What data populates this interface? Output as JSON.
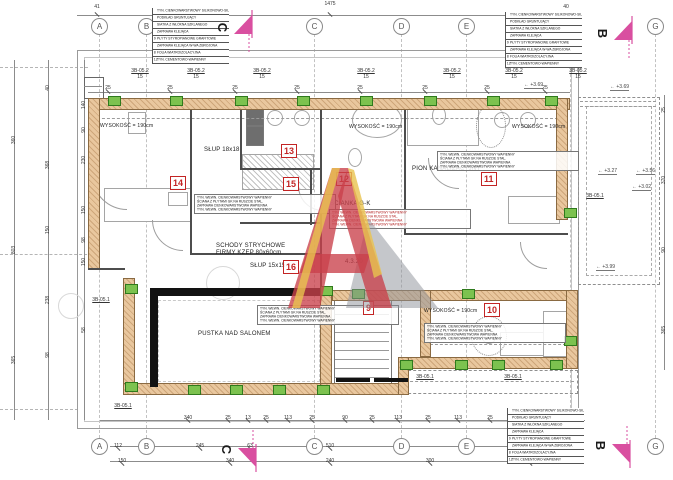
{
  "drawing": {
    "type": "architectural floor plan (attic storey)",
    "language": "Polish",
    "accent_colors": {
      "wall_fill": "#e9c79e",
      "marker_green": "#7cc24f",
      "room_red": "#c32424",
      "section_pink": "#d94fa0",
      "watermark_red": "#c9404a",
      "watermark_yellow": "#e8c34f",
      "watermark_gray": "#8b8f98"
    }
  },
  "grid": {
    "letters": [
      "A",
      "B",
      "C",
      "D",
      "E",
      "F",
      "G"
    ],
    "xs": [
      99,
      146,
      314,
      401,
      466,
      570,
      655
    ],
    "top_y": 18,
    "bottom_y": 438
  },
  "section_markers": [
    {
      "label": "C",
      "x": 218,
      "y": 8,
      "flip": false
    },
    {
      "label": "B",
      "x": 598,
      "y": 14,
      "flip": false
    },
    {
      "label": "C",
      "x": 222,
      "y": 430,
      "flip": true
    },
    {
      "label": "B",
      "x": 596,
      "y": 426,
      "flip": true
    }
  ],
  "legend_rows": [
    {
      "idx": "",
      "t": "TYN. CIENKOWARSTWOWY SILIKONOWO-SILIK."
    },
    {
      "idx": "",
      "t": "PODKŁAD GRUNTUJĄCY"
    },
    {
      "idx": "",
      "t": "SIATKA Z WŁÓKNA SZKLANEGO"
    },
    {
      "idx": "",
      "t": "ZAPRAWA KLEJĄCA"
    },
    {
      "idx": "9",
      "t": "PŁYTY STYROPIANOWE GRAFITOWE"
    },
    {
      "idx": "",
      "t": "ZAPRAWA KLEJĄCA W-WA ZBROJONA"
    },
    {
      "idx": "8",
      "t": "FOLIA WIATROIZOLACYJNA"
    },
    {
      "idx": "12",
      "t": "TYN. CEMENTOWO-WAPIENNY"
    }
  ],
  "legend_positions": [
    {
      "x": 152,
      "y": 8
    },
    {
      "x": 505,
      "y": 12
    },
    {
      "x": 507,
      "y": 408
    }
  ],
  "rooms": [
    {
      "no": "9",
      "x": 363,
      "y": 301
    },
    {
      "no": "10",
      "x": 484,
      "y": 303
    },
    {
      "no": "11",
      "x": 481,
      "y": 172
    },
    {
      "no": "12",
      "x": 336,
      "y": 172
    },
    {
      "no": "13",
      "x": 281,
      "y": 144
    },
    {
      "no": "14",
      "x": 170,
      "y": 176
    },
    {
      "no": "15",
      "x": 283,
      "y": 177
    },
    {
      "no": "16",
      "x": 283,
      "y": 260
    }
  ],
  "height_labels": [
    {
      "t": "WYSOKOŚĆ = 190cm",
      "x": 100,
      "y": 123
    },
    {
      "t": "WYSOKOŚĆ = 190cm",
      "x": 349,
      "y": 124
    },
    {
      "t": "WYSOKOŚĆ = 190cm",
      "x": 512,
      "y": 124
    },
    {
      "t": "WYSOKOŚĆ = 190cm",
      "x": 424,
      "y": 308
    }
  ],
  "notes": [
    {
      "t": "PUSTKA NAD SALONEM",
      "x": 198,
      "y": 331
    },
    {
      "t": "SCHODY STRYCHOWE",
      "x": 216,
      "y": 243
    },
    {
      "t": "FIRMY KZEP 80x60cm",
      "x": 216,
      "y": 250
    },
    {
      "t": "SŁUP 15x15",
      "x": 250,
      "y": 263
    },
    {
      "t": "SŁUP 18x18",
      "x": 204,
      "y": 147
    },
    {
      "t": "PION KANALIZACYJNY",
      "x": 412,
      "y": 166
    },
    {
      "t": "ŚCIANKA G-K",
      "x": 330,
      "y": 201
    },
    {
      "t": "4.3.20",
      "x": 345,
      "y": 259
    }
  ],
  "wall_note_lines": [
    "TYN. WEWN. CIENKOWARSTWOWY WAPIENNY",
    "ŚCIANA Z PŁYTAMI GK NA RUSZCIE STAL.",
    "ZAPRAWA CIENKOWARSTWOWA WAPIENNA",
    "TYN. WEWN. CIENKOWARSTWOWY WAPIENNY"
  ],
  "wall_note_blocks": [
    {
      "x": 194,
      "y": 194,
      "red": false
    },
    {
      "x": 329,
      "y": 209,
      "red": true
    },
    {
      "x": 437,
      "y": 151,
      "red": false
    },
    {
      "x": 257,
      "y": 305,
      "red": false
    },
    {
      "x": 424,
      "y": 323,
      "red": false
    }
  ],
  "elevations": [
    {
      "v": "+3.69",
      "x": 524,
      "y": 82
    },
    {
      "v": "+3.69",
      "x": 610,
      "y": 84
    },
    {
      "v": "+3.27",
      "x": 598,
      "y": 168
    },
    {
      "v": "+3.56",
      "x": 636,
      "y": 168
    },
    {
      "v": "+3.02",
      "x": 632,
      "y": 184
    },
    {
      "v": "+3.99",
      "x": 596,
      "y": 264
    }
  ],
  "dims": {
    "top": [
      {
        "t": "41",
        "x": 97,
        "y": 4
      },
      {
        "t": "1475",
        "x": 330,
        "y": 1
      },
      {
        "t": "40",
        "x": 566,
        "y": 4
      }
    ],
    "post_row": {
      "t": "25",
      "xs": [
        108,
        170,
        235,
        297,
        360,
        425,
        487,
        545
      ],
      "y": 85
    },
    "detail_top": {
      "code": "3B-05.2",
      "sub": "15",
      "xs": [
        140,
        196,
        262,
        366,
        452,
        514,
        578
      ],
      "y": 68
    },
    "detail_bottom": {
      "code": "3B-05.1",
      "pts": [
        {
          "x": 123,
          "y": 403
        },
        {
          "x": 425,
          "y": 374
        },
        {
          "x": 513,
          "y": 374
        },
        {
          "x": 101,
          "y": 297
        },
        {
          "x": 595,
          "y": 193
        }
      ]
    },
    "bottom_rows": [
      {
        "y": 415,
        "items": [
          {
            "t": "340",
            "x": 188
          },
          {
            "t": "25",
            "x": 228
          },
          {
            "t": "13",
            "x": 248
          },
          {
            "t": "25",
            "x": 266
          },
          {
            "t": "113",
            "x": 288
          },
          {
            "t": "25",
            "x": 312
          },
          {
            "t": "90",
            "x": 345
          },
          {
            "t": "25",
            "x": 372
          },
          {
            "t": "113",
            "x": 398
          },
          {
            "t": "25",
            "x": 428
          },
          {
            "t": "113",
            "x": 458
          },
          {
            "t": "25",
            "x": 490
          },
          {
            "t": "63",
            "x": 520
          }
        ]
      },
      {
        "y": 443,
        "items": [
          {
            "t": "112",
            "x": 118
          },
          {
            "t": "40",
            "x": 143
          },
          {
            "t": "245",
            "x": 200
          },
          {
            "t": "63",
            "x": 250
          },
          {
            "t": "510",
            "x": 330
          },
          {
            "t": "343",
            "x": 470
          },
          {
            "t": "40",
            "x": 560
          }
        ]
      },
      {
        "y": 458,
        "items": [
          {
            "t": "150",
            "x": 122
          },
          {
            "t": "340",
            "x": 230
          },
          {
            "t": "240",
            "x": 330
          },
          {
            "t": "300",
            "x": 430
          },
          {
            "t": "233",
            "x": 530
          }
        ]
      }
    ],
    "left_cols": [
      {
        "x": 14,
        "items": [
          {
            "t": "360",
            "y": 140
          },
          {
            "t": "803",
            "y": 250
          },
          {
            "t": "365",
            "y": 360
          }
        ]
      },
      {
        "x": 48,
        "items": [
          {
            "t": "40",
            "y": 88
          },
          {
            "t": "368",
            "y": 165
          },
          {
            "t": "150",
            "y": 230
          },
          {
            "t": "238",
            "y": 300
          },
          {
            "t": "98",
            "y": 355
          }
        ]
      },
      {
        "x": 84,
        "items": [
          {
            "t": "140",
            "y": 105
          },
          {
            "t": "90",
            "y": 130
          },
          {
            "t": "230",
            "y": 160
          },
          {
            "t": "150",
            "y": 210
          },
          {
            "t": "98",
            "y": 240
          },
          {
            "t": "150",
            "y": 262
          },
          {
            "t": "58",
            "y": 330
          }
        ]
      }
    ],
    "right_col": {
      "x": 664,
      "items": [
        {
          "t": "25",
          "y": 110
        },
        {
          "t": "370",
          "y": 180
        },
        {
          "t": "90",
          "y": 250
        },
        {
          "t": "365",
          "y": 330
        }
      ]
    }
  },
  "green_posts": [
    [
      108,
      96
    ],
    [
      170,
      96
    ],
    [
      235,
      96
    ],
    [
      297,
      96
    ],
    [
      360,
      96
    ],
    [
      424,
      96
    ],
    [
      487,
      96
    ],
    [
      545,
      96
    ],
    [
      125,
      284
    ],
    [
      125,
      382
    ],
    [
      188,
      385
    ],
    [
      230,
      385
    ],
    [
      273,
      385
    ],
    [
      317,
      385
    ],
    [
      320,
      286
    ],
    [
      352,
      289
    ],
    [
      462,
      289
    ],
    [
      400,
      360
    ],
    [
      455,
      360
    ],
    [
      492,
      360
    ],
    [
      550,
      360
    ],
    [
      564,
      208
    ],
    [
      564,
      336
    ]
  ]
}
